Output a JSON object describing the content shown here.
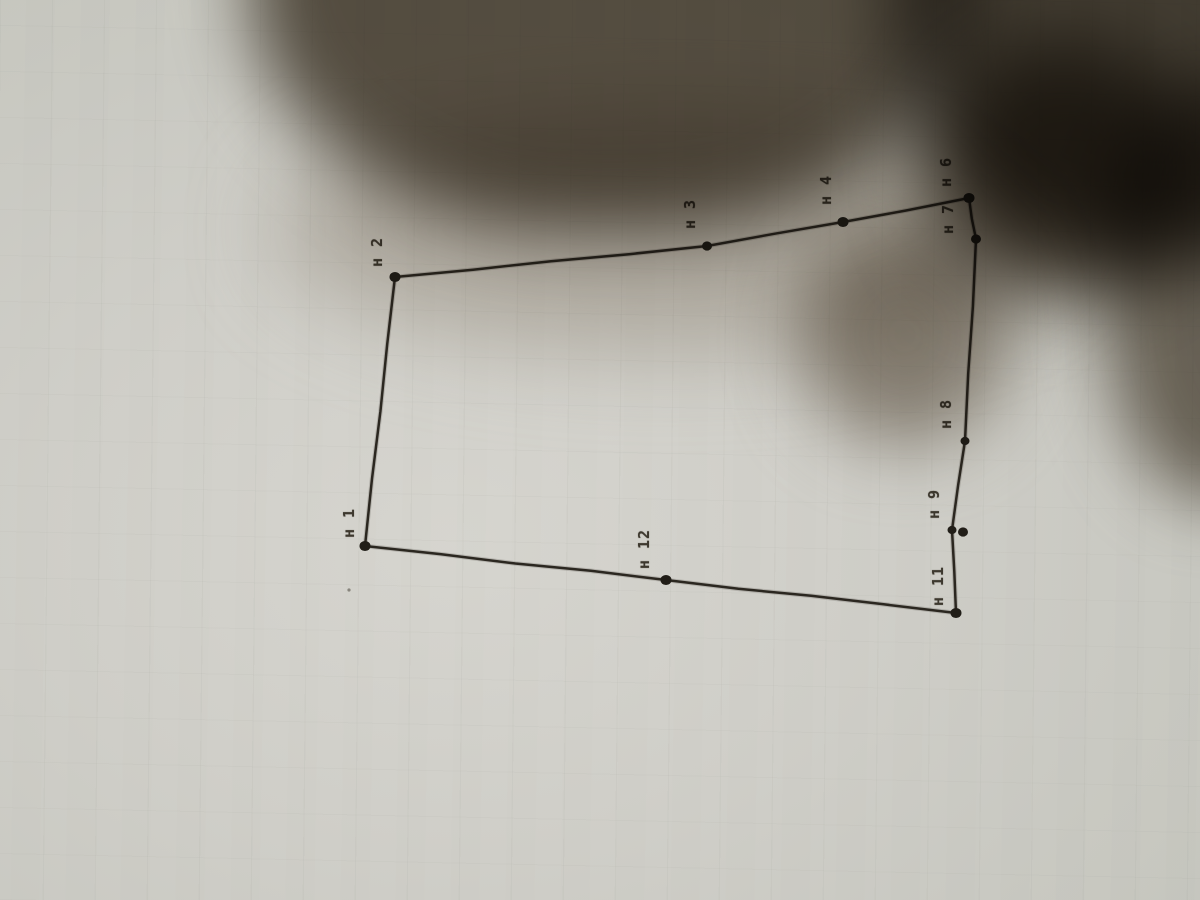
{
  "scene": {
    "kind": "photo of a paper sheet with a hand-drawn land-parcel outline, shadow of a hand/phone across the top",
    "paper_color": "#d0cfc9",
    "shadow_color": "#5a5246",
    "ink_color": "#2b2720",
    "label_color": "#3d382e"
  },
  "chart_data": {
    "type": "scatter",
    "title": "",
    "notes": "closed polygon outline of survey points, labels rotated 90° (read bottom-to-top)",
    "categories": [
      "н 1",
      "н 2",
      "н 3",
      "н 4",
      "н 6",
      "н 7",
      "н 8",
      "н 9",
      "н 11",
      "н 12"
    ]
  },
  "diagram": {
    "type": "polygon-outline",
    "label_rotation_deg": -90,
    "vertices": [
      {
        "id": "n1",
        "label": "н 1",
        "x": 365,
        "y": 546,
        "r": 5.5,
        "lx": 349,
        "ly": 523
      },
      {
        "id": "n2",
        "label": "н 2",
        "x": 395,
        "y": 277,
        "r": 5.5,
        "lx": 377,
        "ly": 252
      },
      {
        "id": "n3",
        "label": "н 3",
        "x": 707,
        "y": 246,
        "r": 5,
        "lx": 690,
        "ly": 214
      },
      {
        "id": "n4",
        "label": "н 4",
        "x": 843,
        "y": 222,
        "r": 5.5,
        "lx": 826,
        "ly": 190
      },
      {
        "id": "n6",
        "label": "н 6",
        "x": 969,
        "y": 198,
        "r": 5.5,
        "lx": 946,
        "ly": 172
      },
      {
        "id": "n7",
        "label": "н 7",
        "x": 976,
        "y": 239,
        "r": 5,
        "lx": 948,
        "ly": 219
      },
      {
        "id": "n8",
        "label": "н 8",
        "x": 965,
        "y": 441,
        "r": 4.5,
        "lx": 946,
        "ly": 414
      },
      {
        "id": "n9",
        "label": "н 9",
        "x": 952,
        "y": 530,
        "r": 4.5,
        "lx": 934,
        "ly": 504
      },
      {
        "id": "n10",
        "label": null,
        "x": 963,
        "y": 532,
        "r": 5,
        "lx": null,
        "ly": null
      },
      {
        "id": "n11",
        "label": "н 11",
        "x": 956,
        "y": 613,
        "r": 5.5,
        "lx": 938,
        "ly": 586
      },
      {
        "id": "n12",
        "label": "н 12",
        "x": 666,
        "y": 580,
        "r": 5.5,
        "lx": 644,
        "ly": 549
      }
    ],
    "outline": [
      "n1",
      "n2",
      "n3",
      "n4",
      "n6",
      "n7",
      "n8",
      "n9",
      "n11",
      "n12"
    ],
    "speck": {
      "x": 349,
      "y": 590
    }
  }
}
